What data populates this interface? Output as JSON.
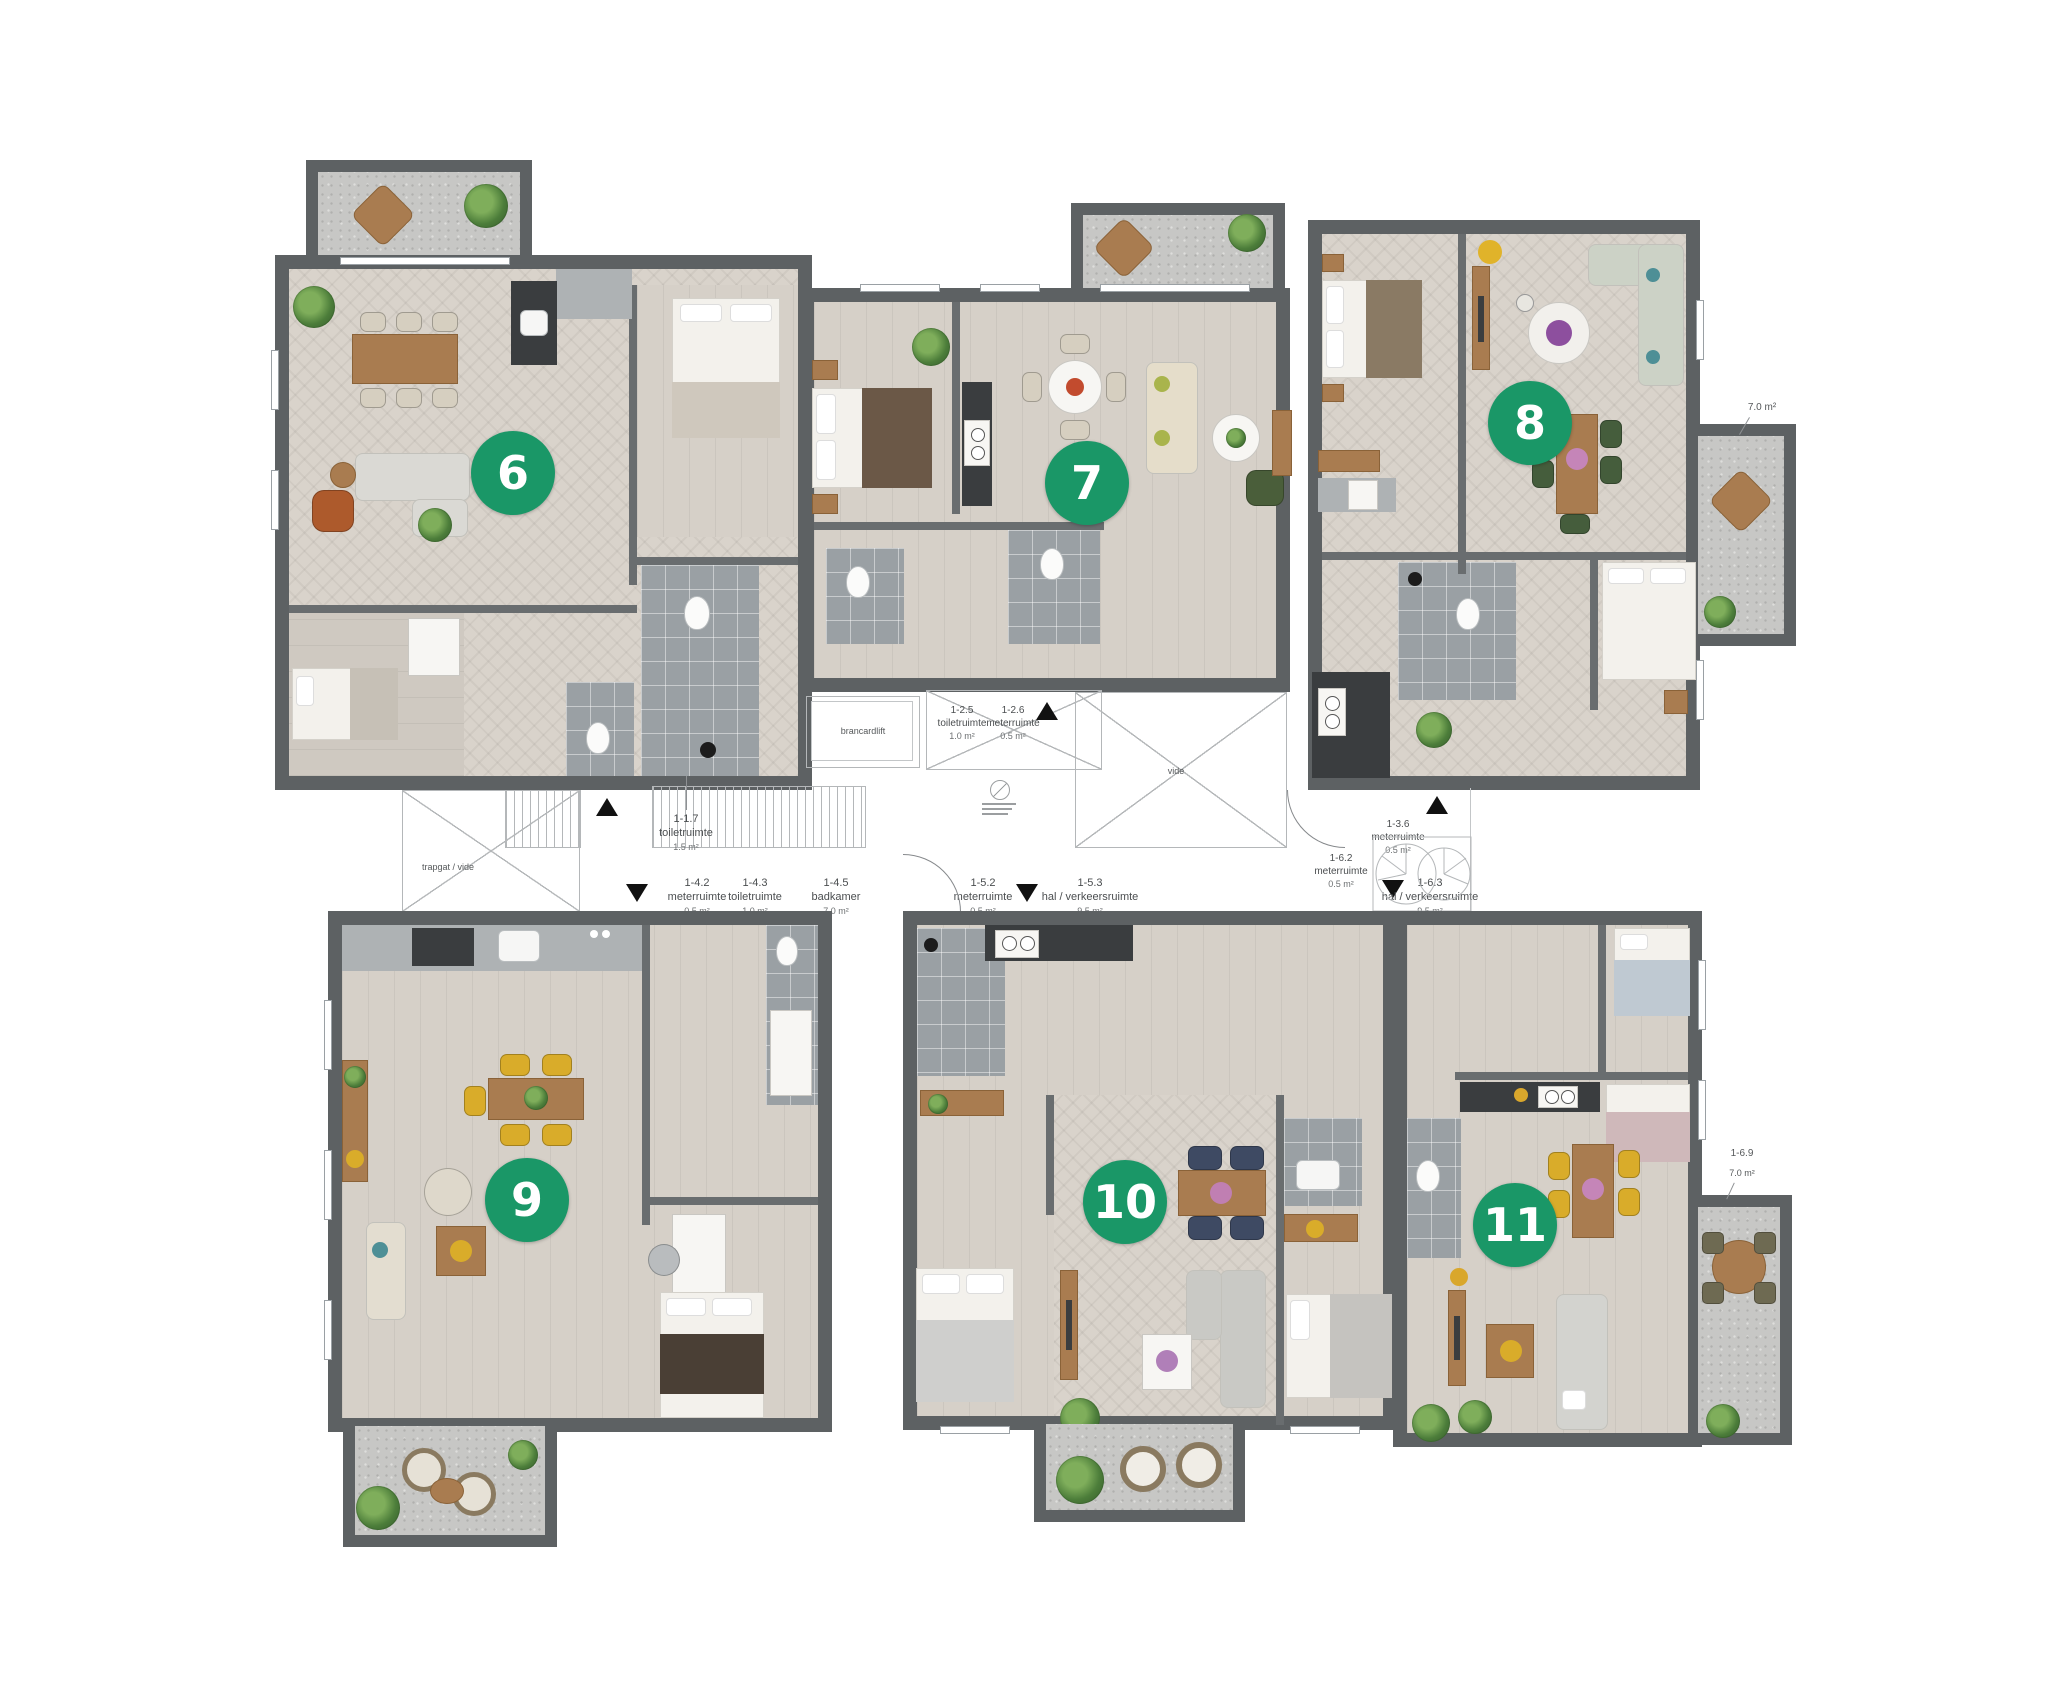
{
  "meta": {
    "type": "apartment-floor-plan",
    "background": "#ffffff"
  },
  "colors": {
    "badge_green": "#1a9767",
    "wall_gray": "#5d6163",
    "tile_gray": "#9aa0a4",
    "wood": "#a97c50",
    "chair_yellow": "#d9ac2a",
    "chair_navy": "#3e4a63",
    "chair_green": "#455d3c"
  },
  "badges": [
    {
      "label": "6"
    },
    {
      "label": "7"
    },
    {
      "label": "8"
    },
    {
      "label": "9"
    },
    {
      "label": "10"
    },
    {
      "label": "11"
    }
  ],
  "room_labels": [
    {
      "id": "1-1.7",
      "name": "toiletruimte",
      "area": "1.5 m²"
    },
    {
      "id": "1-2.5",
      "name": "toiletruimte",
      "area": "1.0 m²"
    },
    {
      "id": "1-2.6",
      "name": "meterruimte",
      "area": "0.5 m²"
    },
    {
      "id": "1-3.6",
      "name": "meterruimte",
      "area": "0.5 m²"
    },
    {
      "id": "1-4.2",
      "name": "meterruimte",
      "area": "0.5 m²"
    },
    {
      "id": "1-4.3",
      "name": "toiletruimte",
      "area": "1.0 m²"
    },
    {
      "id": "1-4.5",
      "name": "badkamer",
      "area": "7.0 m²"
    },
    {
      "id": "1-5.2",
      "name": "meterruimte",
      "area": "0.5 m²"
    },
    {
      "id": "1-5.3",
      "name": "hal / verkeersruimte",
      "area": "9.5 m²"
    },
    {
      "id": "1-6.2",
      "name": "meterruimte",
      "area": "0.5 m²"
    },
    {
      "id": "1-6.3",
      "name": "hal / verkeersruimte",
      "area": "9.5 m²"
    }
  ],
  "annotations": {
    "brancardlift": "brancardlift",
    "vide": "vide",
    "trapgat": "trapgat / vide",
    "terrace8_area": "7.0 m²",
    "terrace11_id": "1-6.9",
    "terrace11_area": "7.0 m²"
  }
}
